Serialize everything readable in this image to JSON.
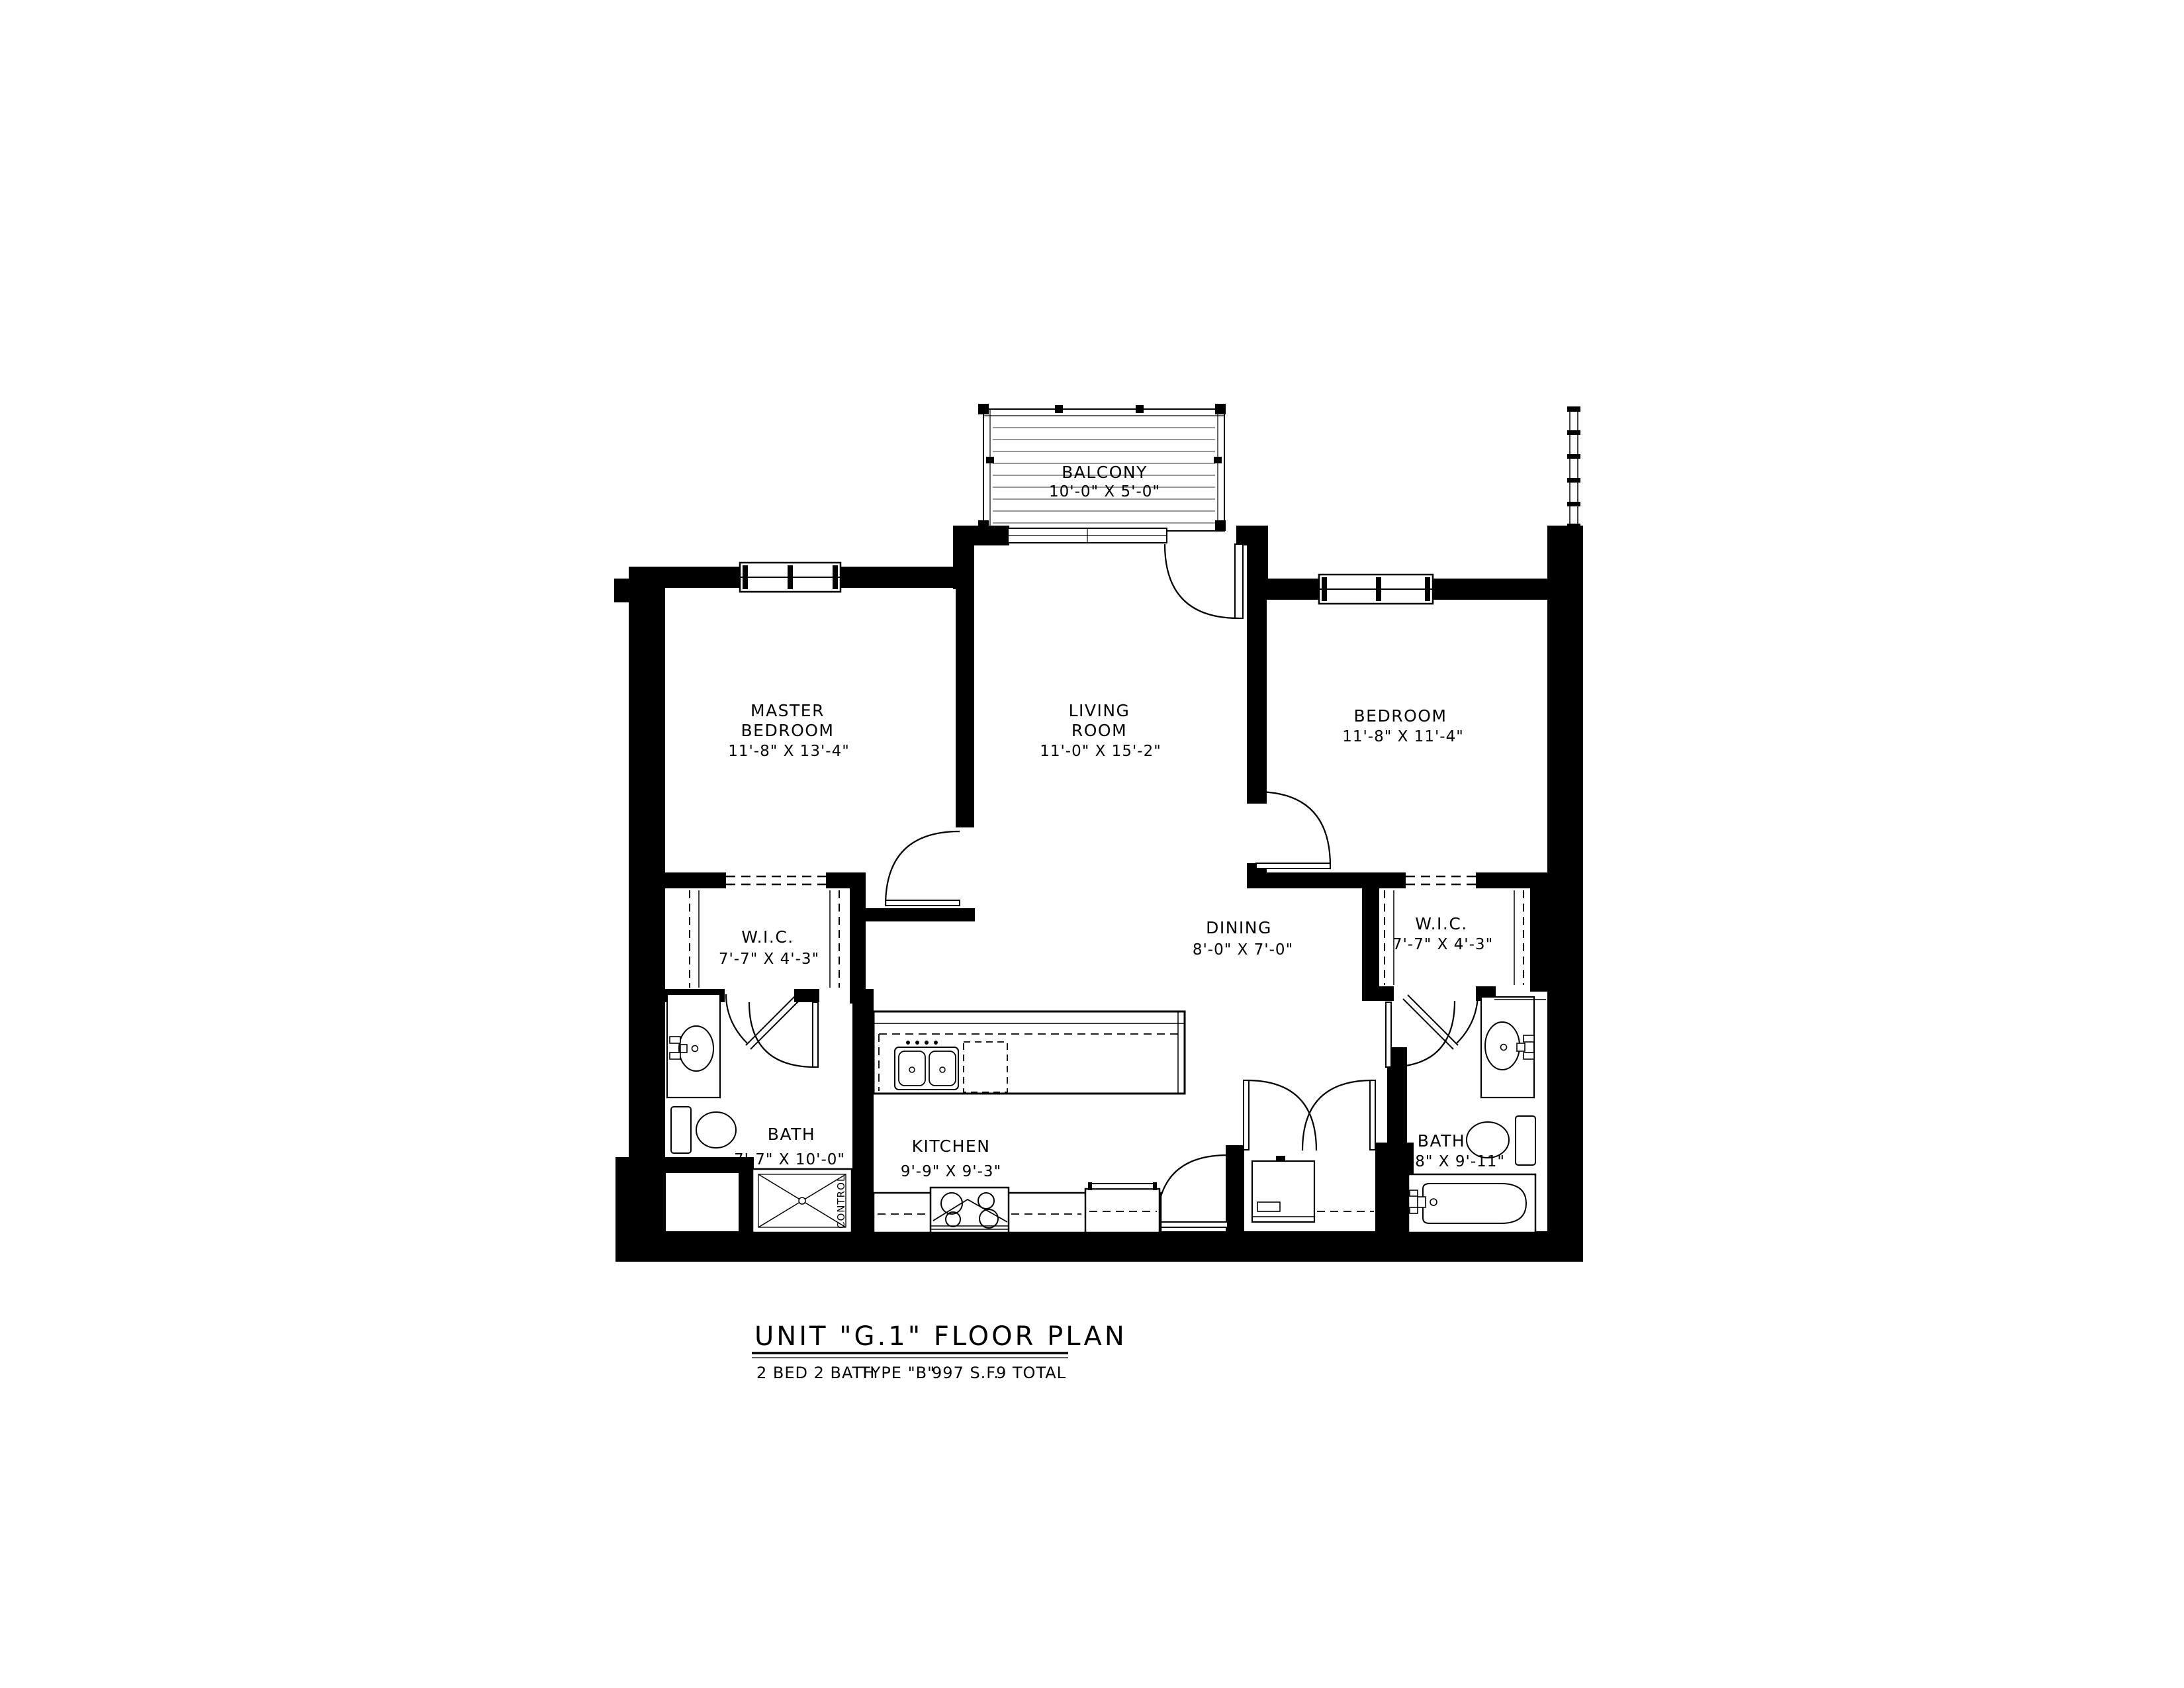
{
  "title": {
    "heading": "UNIT \"G.1\" FLOOR PLAN",
    "subtitle_parts": [
      "2 BED 2 BATH",
      "TYPE \"B\"",
      "997 S.F.",
      "9 TOTAL"
    ]
  },
  "rooms": {
    "balcony": {
      "name": "BALCONY",
      "dims": "10'-0\" X 5'-0\""
    },
    "master_bedroom": {
      "name1": "MASTER",
      "name2": "BEDROOM",
      "dims": "11'-8\" X 13'-4\""
    },
    "living_room": {
      "name1": "LIVING",
      "name2": "ROOM",
      "dims": "11'-0\" X 15'-2\""
    },
    "bedroom": {
      "name": "BEDROOM",
      "dims": "11'-8\" X 11'-4\""
    },
    "wic_left": {
      "name": "W.I.C.",
      "dims": "7'-7\" X 4'-3\""
    },
    "wic_right": {
      "name": "W.I.C.",
      "dims": "7'-7\" X 4'-3\""
    },
    "dining": {
      "name": "DINING",
      "dims": "8'-0\" X 7'-0\""
    },
    "kitchen": {
      "name": "KITCHEN",
      "dims": "9'-9\" X 9'-3\""
    },
    "bath_left": {
      "name": "BATH",
      "dims": "7'-7\" X 10'-0\""
    },
    "bath_right": {
      "name": "BATH",
      "dims": "5'-8\" X 9'-11\""
    }
  },
  "annotations": {
    "shower_control": "CONTROL"
  },
  "colors": {
    "ink": "#000000",
    "paper": "#ffffff",
    "deck_line": "#777777"
  }
}
